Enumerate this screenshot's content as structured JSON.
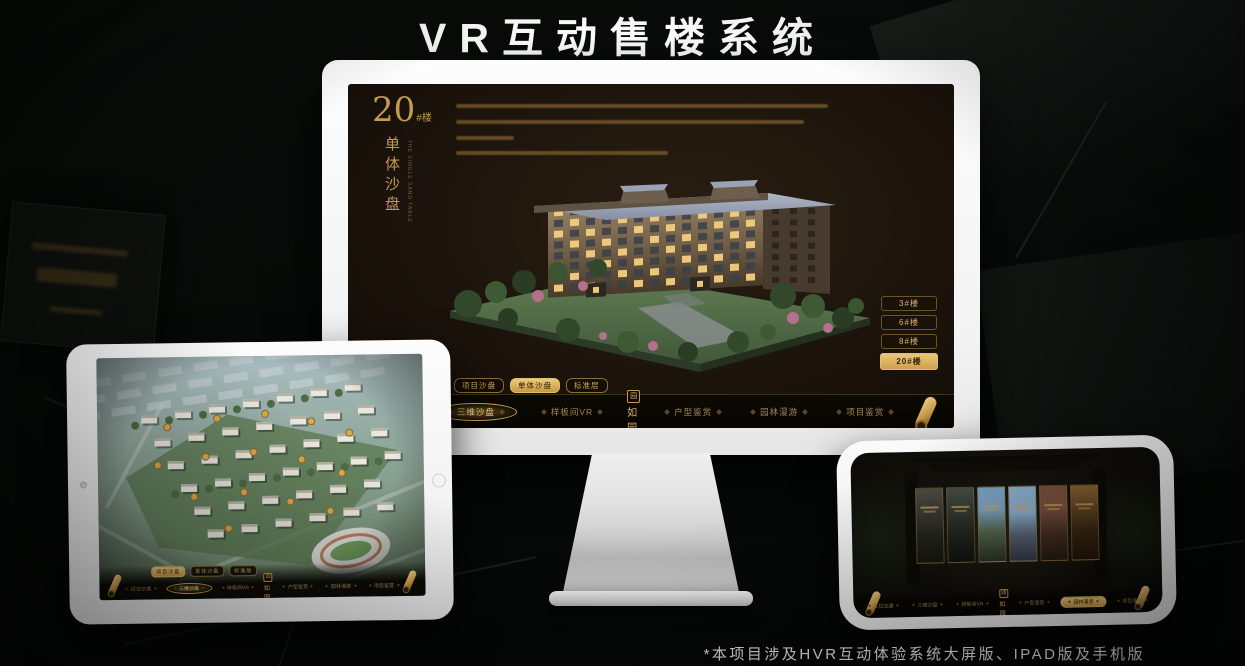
{
  "title": "VR互动售楼系统",
  "footnote": "*本项目涉及HVR互动体验系统大屏版、IPAD版及手机版",
  "logo": {
    "name": "如园",
    "seal_char": "园"
  },
  "colors": {
    "gold": "#c99b4e",
    "gold_bright": "#e8c470",
    "screen_bg": "#1c140c",
    "navbar_bg": "#0a0703"
  },
  "desktop": {
    "heading": {
      "number": "20",
      "suffix": "#楼",
      "subtitle": "单体沙盘",
      "subtitle_en": "THE SINGLE SAND TABLE"
    },
    "floor_buttons": [
      {
        "label": "3#楼",
        "active": false
      },
      {
        "label": "6#楼",
        "active": false
      },
      {
        "label": "8#楼",
        "active": false
      },
      {
        "label": "20#楼",
        "active": true
      }
    ],
    "sub_tabs": [
      {
        "label": "项目沙盘",
        "active": false
      },
      {
        "label": "单体沙盘",
        "active": true
      },
      {
        "label": "标准层",
        "active": false
      }
    ],
    "nav_items": [
      {
        "label": "区位交通",
        "active": false
      },
      {
        "label": "三维沙盘",
        "active": true
      },
      {
        "label": "样板间VR",
        "active": false
      },
      {
        "logo": true
      },
      {
        "label": "户型鉴赏",
        "active": false
      },
      {
        "label": "园林漫游",
        "active": false
      },
      {
        "label": "项目鉴赏",
        "active": false
      }
    ]
  },
  "tablet": {
    "sub_tabs": [
      {
        "label": "项目沙盘",
        "active": true
      },
      {
        "label": "单体沙盘",
        "active": false
      },
      {
        "label": "标准层",
        "active": false
      }
    ],
    "nav_items": [
      {
        "label": "区位交通",
        "active": false
      },
      {
        "label": "三维沙盘",
        "active": true
      },
      {
        "label": "样板间VR",
        "active": false
      },
      {
        "logo": true
      },
      {
        "label": "户型鉴赏",
        "active": false
      },
      {
        "label": "园林漫游",
        "active": false
      },
      {
        "label": "项目鉴赏",
        "active": false
      }
    ]
  },
  "phone": {
    "gallery_panel_count": 6,
    "nav_items": [
      {
        "label": "区位交通",
        "active": false
      },
      {
        "label": "三维沙盘",
        "active": false
      },
      {
        "label": "样板间VR",
        "active": false
      },
      {
        "logo": true
      },
      {
        "label": "户型鉴赏",
        "active": false
      },
      {
        "label": "园林漫游",
        "active": true
      },
      {
        "label": "项目鉴赏",
        "active": false
      }
    ]
  }
}
